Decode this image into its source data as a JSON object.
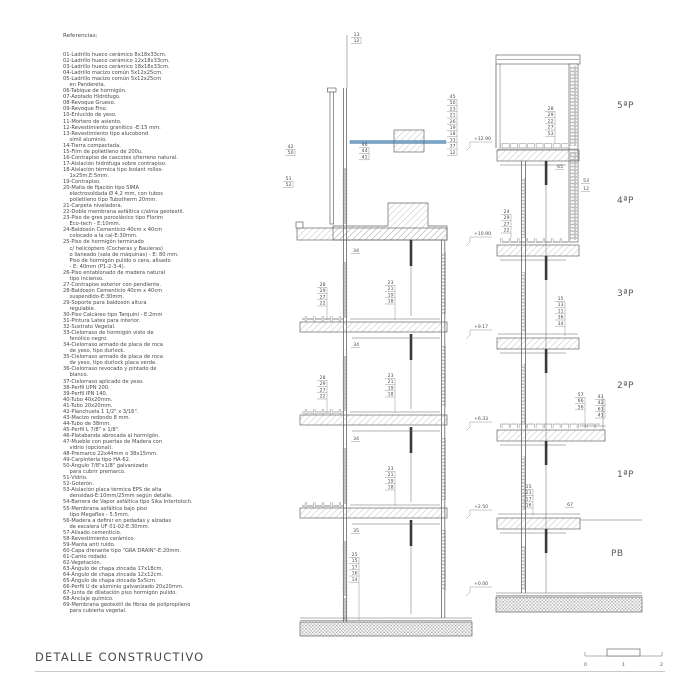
{
  "title": "DETALLE CONSTRUCTIVO",
  "colors": {
    "line": "#666666",
    "text": "#4a4a4a",
    "dark": "#3a3a3a",
    "blue": "#7aa5c9"
  },
  "references": {
    "heading": "Referencias:",
    "lines": [
      "01-Ladrillo hueco cerámico 8x18x33cm.",
      "02-Ladrillo hueco cerámico 12x18x33cm.",
      "03-Ladrillo hueco cerámico 18x18x33cm.",
      "04-Ladrillo macizo común 5x12x25cm.",
      "05-Ladrillo macizo común 5x12x25cm",
      "    en Pandereta.",
      "06-Tabique de hormigón.",
      "07-Azotado Hidrófugo.",
      "08-Revoque Grueso.",
      "09-Revoque Fino.",
      "10-Enlucido de yeso.",
      "11-Mortero de asiento.",
      "12-Revestimiento granítico -E:15 mm.",
      "13-Revestimiento tipo alucobond",
      "    símil aluminio.",
      "14-Tierra compactada.",
      "15-Film de polietileno de 200u.",
      "16-Contrapiso de cascotes s/terreno natural.",
      "17-Aislación hidrófuga sobre contrapiso.",
      "18-Aislación térmica tipo Isolant rollos-",
      "    1x25m,E:5mm.",
      "19-Contrapiso.",
      "20-Malla de fijación tipo SIMA",
      "    electrosoldada Ø 4,2 mm, con tubos",
      "    polietileno tipo Tubotherm 20mm.",
      "21-Carpeta niveladora.",
      "22-Doble membrana asfáltica c/alma geotextil.",
      "23-Piso de gres porcelánico tipo Florim",
      "    Eco-tech - E:10mm.",
      "24-Baldosón Cementicio 40cm x 40cm",
      "    colocado a la cal-E:30mm.",
      "25-Piso de hormigón terminado",
      "    c/ helicóptero (Cocheras y Bauleras)",
      "    o llaneado (sala de máquinas) - E: 80 mm.",
      "    Piso de hormigón pulido o cera, alisado",
      "    - E: 40mm (P1-2-3-4).",
      "26-Piso entablonado de madera natural",
      "    tipo incienso.",
      "27-Contrapiso exterior con pendiente.",
      "28-Baldosón Cementicio 40cm x 40cm",
      "    suspendido-E:30mm.",
      "29-Soporte para baldosón altura",
      "    regulable.",
      "30-Piso Calcáreo tipo Tarquini - E:2mm",
      "31-Pintura Latex para interior.",
      "32-Sustrato Vegetal.",
      "33-Cielorraso de hormigón visto de",
      "    fenólico negro.",
      "34-Cielorraso armado de placa de roca",
      "    de yeso, tipo durlock.",
      "35-Cielorraso armado de placa de roca",
      "    de yeso, tipo durlock placa verde.",
      "36-Cielorraso revocado y pintado de",
      "    blanco.",
      "37-Cielorraso aplicado de yeso.",
      "38-Perfil UPN 200.",
      "39-Perfil IPN 140.",
      "40-Tubo 40x20mm.",
      "41-Tubo 20x20mm.",
      "42-Planchuela 1 1/2\" x 3/16\".",
      "43-Macizo redondo 8 mm.",
      "44-Tubo de 38mm.",
      "45-Perfil L 7/8\" x 1/8\".",
      "46-Platabanda abrocada al hormigón.",
      "47-Mueble con puertas de Madera con",
      "    vidrio (opcional).",
      "48-Premarco 22x44mm o 38x15mm.",
      "49-Carpintería tipo HA-62.",
      "50-Ángulo 7/8\"x1/8\" galvanizado",
      "    para cubrir premarco.",
      "51-Vidrio.",
      "52-Goterón.",
      "53-Aislación placa térmica EPS de alta",
      "    densidad-E:10mm/25mm según detalle.",
      "54-Barrera de Vapor asfáltica tipo Sika Intertolsch.",
      "55-Membrana asfáltica bajo piso",
      "    tipo Megaflex - 5.5mm.",
      "56-Madera a definir en pedadas y alzadas",
      "    de escalera UF 01-02-E:30mm.",
      "57-Alisado cementicio.",
      "58-Revestimiento cerámico.",
      "59-Manta anti ruido.",
      "60-Capa drenante tipo \"GRA DRAIN\"-E:20mm.",
      "61-Canto rodado.",
      "62-Vegetación.",
      "63-Ángulo de chapa zincada 17x18cm.",
      "64-Ángulo de chapa zincada 12x12cm.",
      "65-Ángulo de chapa zincada 5x5cm.",
      "66-Perfil U de aluminio galvanizado 20x20mm.",
      "67-Junta de dilatación piso hormigón pulido.",
      "68-Anclaje químico.",
      "69-Membrana geotextil de fibras de polipropileno",
      "    para cubierta vegetal."
    ]
  },
  "drawing": {
    "floors": [
      {
        "t": "5ªP",
        "x": 617,
        "y": 108
      },
      {
        "t": "4ªP",
        "x": 617,
        "y": 203
      },
      {
        "t": "3ªP",
        "x": 617,
        "y": 296
      },
      {
        "t": "2ªP",
        "x": 617,
        "y": 388
      },
      {
        "t": "1ªP",
        "x": 617,
        "y": 477
      },
      {
        "t": "PB",
        "x": 611,
        "y": 556
      }
    ],
    "elevations": [
      {
        "v": "+12.90",
        "y": 142
      },
      {
        "v": "+10.90",
        "y": 237
      },
      {
        "v": "+9.17",
        "y": 330
      },
      {
        "v": "+6.33",
        "y": 422
      },
      {
        "v": "+2.50",
        "y": 510
      },
      {
        "v": "+0.00",
        "y": 587
      }
    ],
    "ladders": [
      {
        "x": 286,
        "y": 148,
        "items": [
          "42",
          "50"
        ],
        "drop": 0
      },
      {
        "x": 284,
        "y": 180,
        "items": [
          "51",
          "52"
        ],
        "drop": 0
      },
      {
        "x": 360,
        "y": 146,
        "items": [
          "46",
          "44",
          "41"
        ],
        "drop": 0
      },
      {
        "x": 448,
        "y": 98,
        "items": [
          "45",
          "50",
          "23",
          "21",
          "26",
          "19",
          "18",
          "33",
          "37",
          "12"
        ],
        "drop": 0
      },
      {
        "x": 352,
        "y": 36,
        "items": [
          "13",
          "12"
        ],
        "drop": 0
      },
      {
        "x": 318,
        "y": 286,
        "items": [
          "28",
          "29",
          "27",
          "22"
        ],
        "drop": 320
      },
      {
        "x": 386,
        "y": 284,
        "items": [
          "23",
          "21",
          "19",
          "18"
        ],
        "drop": 320
      },
      {
        "x": 318,
        "y": 379,
        "items": [
          "28",
          "29",
          "27",
          "22"
        ],
        "drop": 413
      },
      {
        "x": 386,
        "y": 377,
        "items": [
          "23",
          "21",
          "19",
          "18"
        ],
        "drop": 413
      },
      {
        "x": 386,
        "y": 470,
        "items": [
          "23",
          "21",
          "19",
          "18"
        ],
        "drop": 506
      },
      {
        "x": 350,
        "y": 556,
        "items": [
          "25",
          "15",
          "17",
          "16",
          "14"
        ],
        "drop": 620
      },
      {
        "x": 546,
        "y": 110,
        "items": [
          "28",
          "29",
          "22",
          "27",
          "53"
        ],
        "drop": 143
      },
      {
        "x": 502,
        "y": 213,
        "items": [
          "24",
          "29",
          "27",
          "22"
        ],
        "drop": 238
      },
      {
        "x": 556,
        "y": 300,
        "items": [
          "15",
          "13",
          "11",
          "36",
          "34"
        ],
        "drop": 336
      },
      {
        "x": 576,
        "y": 396,
        "items": [
          "57",
          "66",
          "56"
        ],
        "drop": 428
      },
      {
        "x": 596,
        "y": 398,
        "items": [
          "43",
          "42",
          "63",
          "41"
        ],
        "drop": 0
      },
      {
        "x": 524,
        "y": 488,
        "items": [
          "15",
          "21",
          "17",
          "16"
        ],
        "drop": 516
      }
    ],
    "labels": [
      {
        "x": 556,
        "y": 168,
        "t": "65"
      },
      {
        "x": 582,
        "y": 182,
        "t": "53"
      },
      {
        "x": 582,
        "y": 190,
        "t": "12"
      },
      {
        "x": 566,
        "y": 506,
        "t": "67"
      },
      {
        "x": 352,
        "y": 252,
        "t": "34"
      },
      {
        "x": 352,
        "y": 346,
        "t": "34"
      },
      {
        "x": 352,
        "y": 440,
        "t": "34"
      },
      {
        "x": 352,
        "y": 532,
        "t": "35"
      }
    ]
  },
  "scalebar": {
    "labels": [
      "0",
      "1",
      "2"
    ]
  }
}
